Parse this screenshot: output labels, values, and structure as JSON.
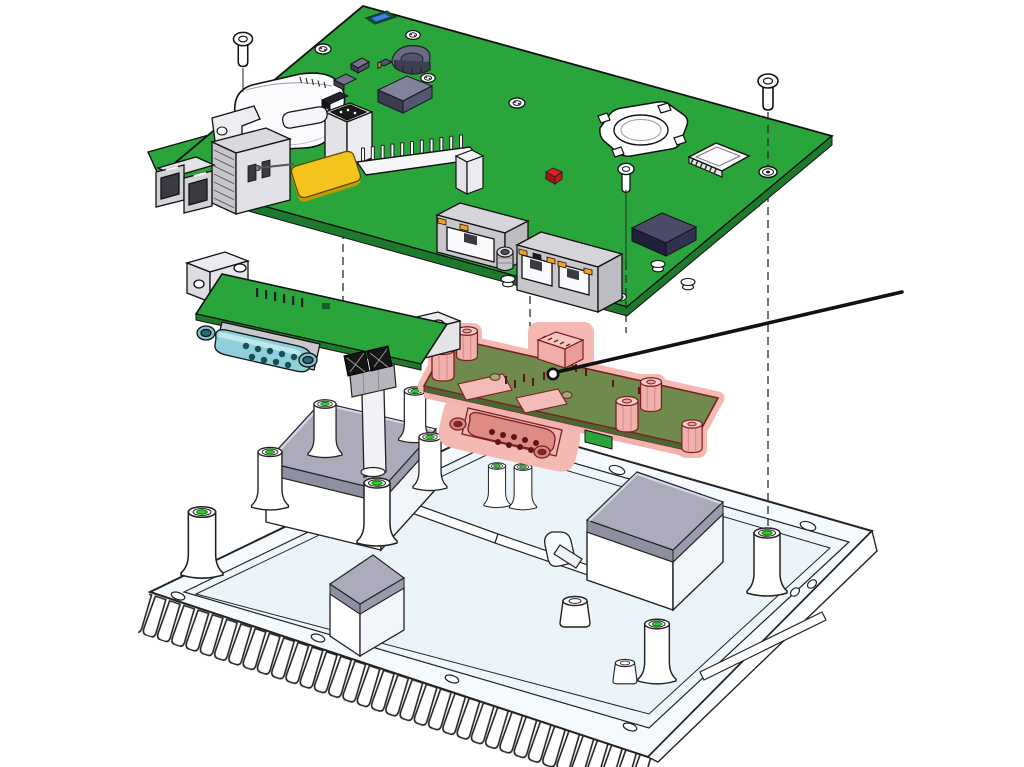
{
  "figure": {
    "type": "exploded-view-diagram",
    "subject": "embedded-computer-on-heatsink-chassis",
    "background": "#ffffff",
    "callout": {
      "label": "Pos. 01",
      "target": "io-daughter-board",
      "line_color": "#111111"
    },
    "colors": {
      "pcb_green": "#2aa53c",
      "pcb_green_dark": "#1d7a2c",
      "olive_board": "#6e8b4d",
      "highlight_pink": "#f5b9b4",
      "highlight_outline": "#7a1f1f",
      "teal_connector": "#8ed0da",
      "antenna_yellow": "#f4c31e",
      "thermal_pad": "#ababbc",
      "base_fill": "#f4fafd",
      "hole_green": "#22d622",
      "led_orange": "#f7a11a",
      "led_red": "#e02020",
      "chip_slate": "#82829b",
      "chip_navy": "#4b4b68",
      "outline": "#1a1a1a"
    },
    "parts": [
      {
        "id": "main-board",
        "label": "main carrier PCB"
      },
      {
        "id": "mounting-screw",
        "label": "mounting screw",
        "count": 3
      },
      {
        "id": "speaker-housing",
        "label": "white component housing"
      },
      {
        "id": "lc-fiber-connector",
        "label": "LC fiber optic connector"
      },
      {
        "id": "sfp-cage",
        "label": "SFP cage"
      },
      {
        "id": "antenna-pad",
        "label": "yellow antenna pad"
      },
      {
        "id": "pin-headers",
        "label": "pin headers"
      },
      {
        "id": "coin-cell-holder",
        "label": "coin cell battery holder"
      },
      {
        "id": "micro-sd-slot",
        "label": "microSD card slot"
      },
      {
        "id": "status-led",
        "label": "red status LED"
      },
      {
        "id": "rj45-single",
        "label": "RJ45 jack"
      },
      {
        "id": "rj45-dual",
        "label": "dual RJ45 jack"
      },
      {
        "id": "serial-adapter-board",
        "label": "serial adapter board with D-sub 9"
      },
      {
        "id": "io-daughter-board",
        "label": "highlighted I/O daughter board (Pos. 01)"
      },
      {
        "id": "heatsink-chassis",
        "label": "finned heatsink chassis"
      },
      {
        "id": "thermal-pad",
        "label": "thermal pad pedestal",
        "count": 3
      },
      {
        "id": "standoff-pillar",
        "label": "standoff pillar",
        "count": 10
      }
    ]
  }
}
